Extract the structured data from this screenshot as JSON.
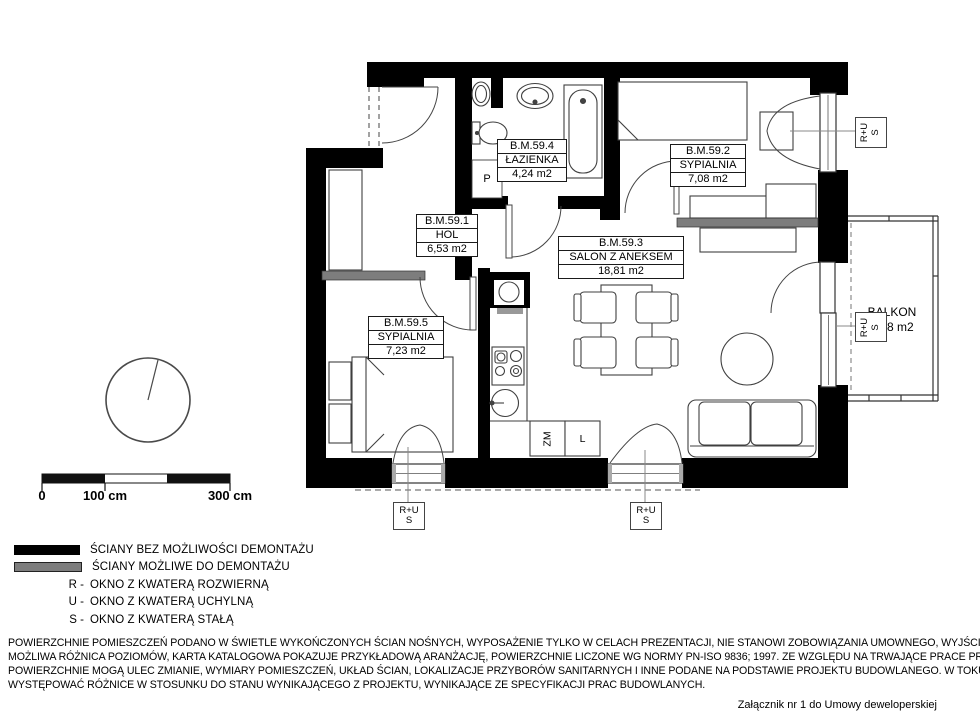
{
  "rooms": [
    {
      "id": "B.M.59.1",
      "name": "HOL",
      "area": "6,53 m2"
    },
    {
      "id": "B.M.59.2",
      "name": "SYPIALNIA",
      "area": "7,08 m2"
    },
    {
      "id": "B.M.59.3",
      "name": "SALON Z ANEKSEM",
      "area": "18,81 m2"
    },
    {
      "id": "B.M.59.4",
      "name": "ŁAZIENKA",
      "area": "4,24 m2"
    },
    {
      "id": "B.M.59.5",
      "name": "SYPIALNIA",
      "area": "7,23 m2"
    }
  ],
  "balcony": {
    "name": "BALKON",
    "area": "1,88 m2"
  },
  "window_tags": {
    "line1": "R+U",
    "line2": "S"
  },
  "appliances": {
    "washer": "P",
    "dishwasher": "ZM",
    "fridge": "L"
  },
  "scale": {
    "tick0": "0",
    "tick100": "100 cm",
    "tick300": "300 cm"
  },
  "legend": {
    "wall_solid": "ŚCIANY BEZ MOŻLIWOŚCI DEMONTAŻU",
    "wall_removable": "ŚCIANY MOŻLIWE DO DEMONTAŻU",
    "r_key": "R -",
    "r_label": "OKNO Z KWATERĄ ROZWIERNĄ",
    "u_key": "U -",
    "u_label": "OKNO Z KWATERĄ UCHYLNĄ",
    "s_key": "S -",
    "s_label": "OKNO Z KWATERĄ STAŁĄ"
  },
  "footer": {
    "lines": [
      "POWIERZCHNIE POMIESZCZEŃ PODANO W ŚWIETLE WYKOŃCZONYCH ŚCIAN NOŚNYCH, WYPOSAŻENIE TYLKO W CELACH PREZENTACJI, NIE STANOWI ZOBOWIĄZANIA UMOWNEGO, WYJŚCIE NA TARAS/LOGGIE-",
      "MOŻLIWA RÓŻNICA POZIOMÓW, KARTA KATALOGOWA POKAZUJE PRZYKŁADOWĄ ARANŻACJĘ, POWIERZCHNIE LICZONE WG NORMY PN-ISO 9836; 1997. ZE WZGLĘDU NA TRWAJĄCE PRACE PROJEKTOWE,",
      "POWIERZCHNIE MOGĄ ULEC ZMIANIE, WYMIARY POMIESZCZEŃ, UKŁAD ŚCIAN, LOKALIZACJE PRZYBORÓW SANITARNYCH I INNE PODANE NA PODSTAWIE PROJEKTU BUDOWLANEGO. W TOKU BUDOWY MOGĄ",
      "WYSTĘPOWAĆ RÓŻNICE W STOSUNKU DO STANU WYNIKAJĄCEGO Z PROJEKTU, WYNIKAJĄCE ZE SPECYFIKACJI PRAC BUDOWLANYCH."
    ],
    "attachment": "Załącznik nr 1 do Umowy deweloperskiej"
  },
  "colors": {
    "wall": "#000000",
    "wall_removable": "#7d7d7d"
  }
}
